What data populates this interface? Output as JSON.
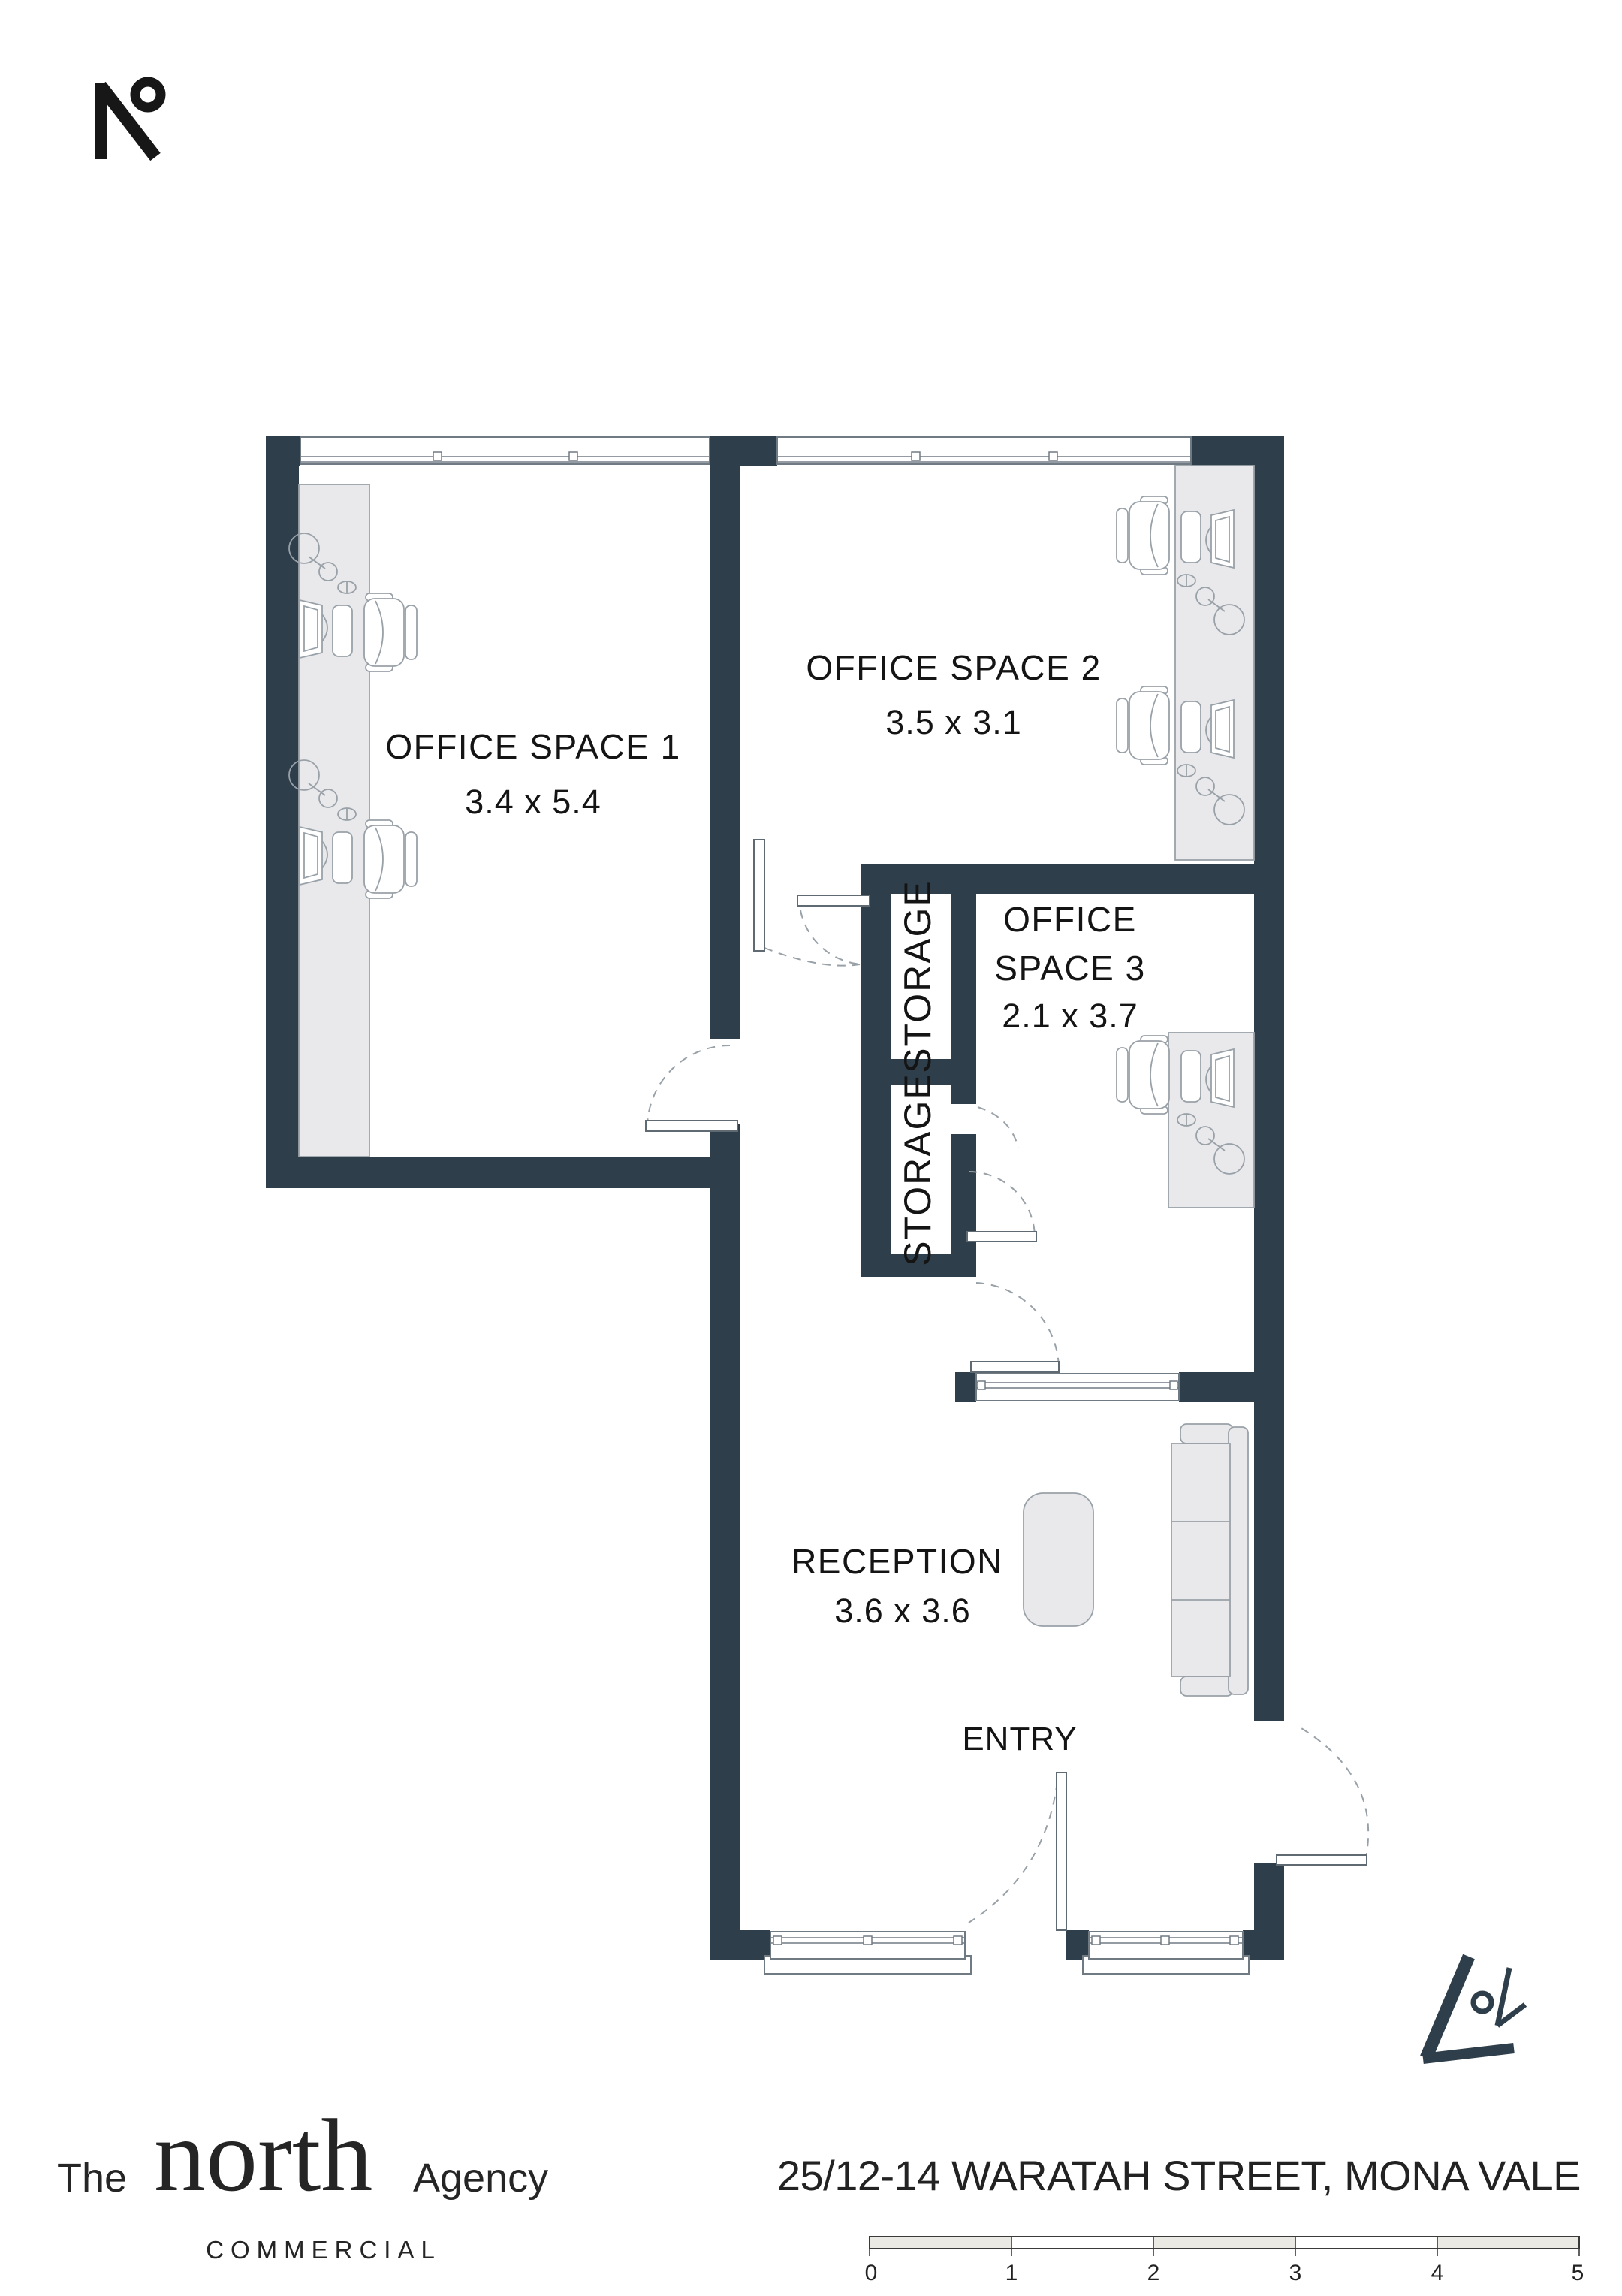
{
  "colors": {
    "wall": "#2e3e4b",
    "line": "#99a1a8",
    "furniture_fill": "#e9e9ec",
    "accent_dark": "#171717",
    "scale_shade": "#eae9e3"
  },
  "plan": {
    "rooms": [
      {
        "id": "office1",
        "name": "OFFICE SPACE 1",
        "dims": "3.4 x 5.4"
      },
      {
        "id": "office2",
        "name": "OFFICE SPACE 2",
        "dims": "3.5 x 3.1"
      },
      {
        "id": "office3",
        "name_line1": "OFFICE",
        "name_line2": "SPACE 3",
        "dims": "2.1 x 3.7"
      },
      {
        "id": "reception",
        "name": "RECEPTION",
        "dims": "3.6 x 3.6"
      }
    ],
    "storage_label": "STORAGE",
    "entry_label": "ENTRY"
  },
  "footer": {
    "brand": {
      "prefix": "The",
      "name": "north",
      "suffix": "Agency",
      "tagline": "COMMERCIAL"
    },
    "address": "25/12-14 WARATAH STREET, MONA VALE"
  },
  "scale_bar": {
    "unit_labels": [
      "0",
      "1",
      "2",
      "3",
      "4",
      "5"
    ]
  },
  "icons": {
    "top_left": "north-degree-logo-icon",
    "bottom_right": "north-compass-icon"
  }
}
